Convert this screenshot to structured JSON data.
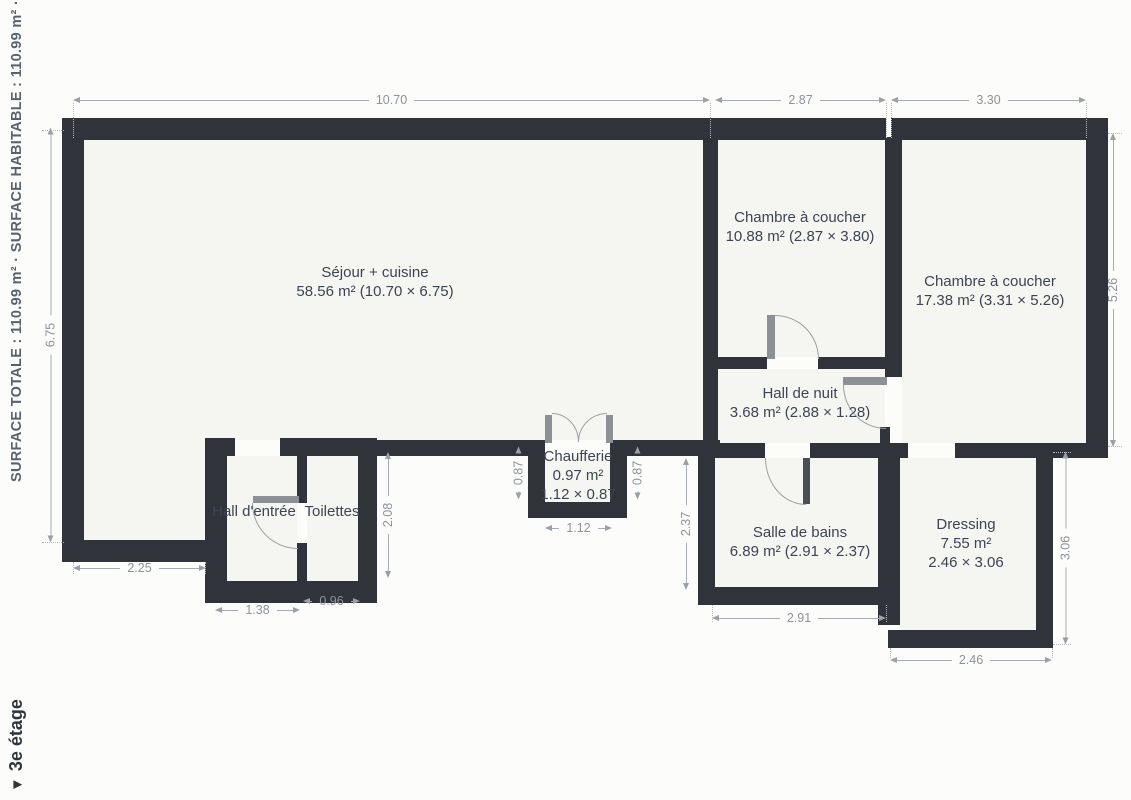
{
  "sidebar": {
    "surface_summary": "SURFACE TOTALE : 110.99 m²  ·  SURFACE HABITABLE : 110.99 m²  ·  PIÈCES",
    "floor_marker": "▼",
    "floor_label": "3e étage"
  },
  "rooms": [
    {
      "name": "Séjour + cuisine",
      "area": "58.56 m² (10.70 × 6.75)"
    },
    {
      "name": "Chambre à coucher",
      "area": "10.88 m² (2.87 × 3.80)"
    },
    {
      "name": "Chambre à coucher",
      "area": "17.38 m² (3.31 × 5.26)"
    },
    {
      "name": "Hall de nuit",
      "area": "3.68 m² (2.88 × 1.28)"
    },
    {
      "name": "Chaufferie",
      "area": "0.97 m²",
      "dims": "1.12 × 0.87"
    },
    {
      "name": "Hall d'entrée"
    },
    {
      "name": "Toilettes"
    },
    {
      "name": "Salle de bains",
      "area": "6.89 m² (2.91 × 2.37)"
    },
    {
      "name": "Dressing",
      "area": "7.55 m²",
      "dims": "2.46 × 3.06"
    }
  ],
  "dims": {
    "top_sejour": "10.70",
    "top_ch1": "2.87",
    "top_ch2": "3.30",
    "sejour_h": "6.75",
    "ch2_h": "5.26",
    "sejour_left_w": "2.25",
    "entree_w": "1.38",
    "toilettes_w": "0.96",
    "toilettes_h": "2.08",
    "chaufferie_left_h": "0.87",
    "chaufferie_right_h": "0.87",
    "chaufferie_w": "1.12",
    "sdb_h": "2.37",
    "sdb_w": "2.91",
    "dressing_w": "2.46",
    "dressing_h": "3.06"
  },
  "colors": {
    "wall": "#30343a",
    "floor": "#f5f5f1",
    "room_text": "#3d4554",
    "dim_text": "#8d939b"
  }
}
